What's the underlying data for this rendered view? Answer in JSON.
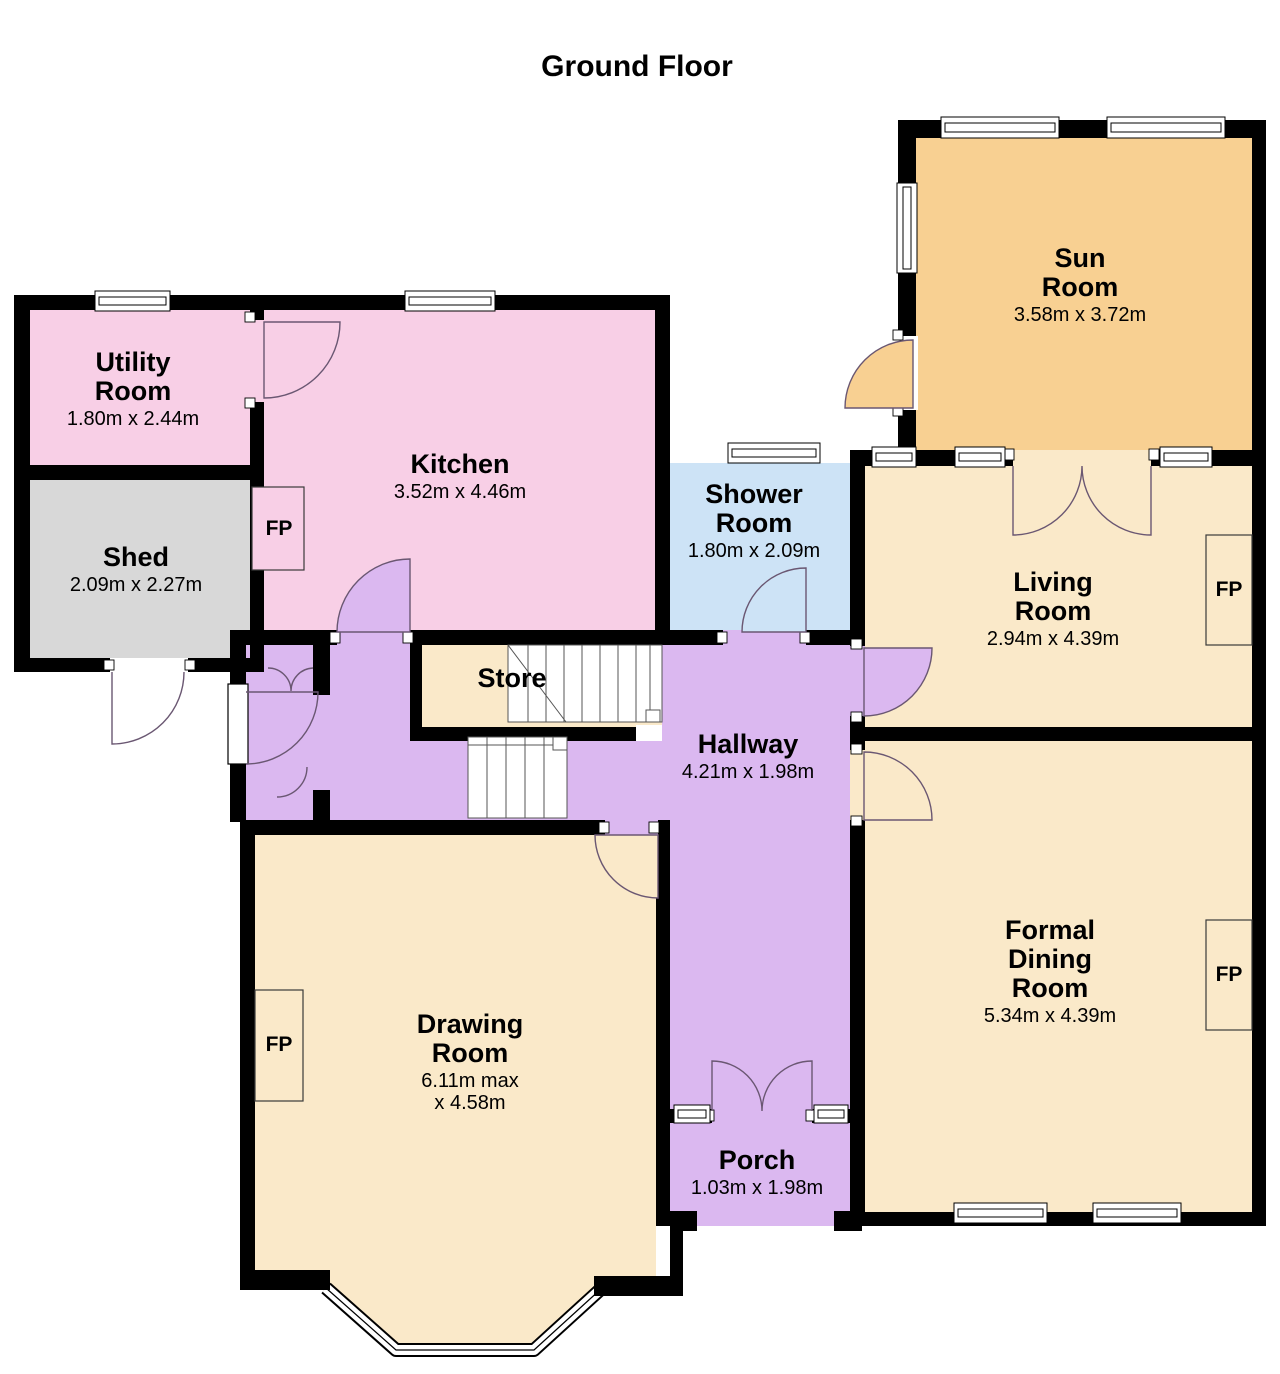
{
  "title": "Ground Floor",
  "rooms": [
    {
      "id": "utility-room",
      "name": "Utility Room",
      "dims": "1.80m x 2.44m",
      "color": "#f8cfe6"
    },
    {
      "id": "shed",
      "name": "Shed",
      "dims": "2.09m x 2.27m",
      "color": "#d8d8d8"
    },
    {
      "id": "kitchen",
      "name": "Kitchen",
      "dims": "3.52m x 4.46m",
      "color": "#f8cfe6"
    },
    {
      "id": "shower-room",
      "name": "Shower Room",
      "dims": "1.80m x 2.09m",
      "color": "#cde3f6"
    },
    {
      "id": "sun-room",
      "name": "Sun Room",
      "dims": "3.58m x 3.72m",
      "color": "#f8d092"
    },
    {
      "id": "living-room",
      "name": "Living Room",
      "dims": "2.94m x 4.39m",
      "color": "#fae9c9"
    },
    {
      "id": "store",
      "name": "Store",
      "dims": "",
      "color": "#fae9c9"
    },
    {
      "id": "hallway",
      "name": "Hallway",
      "dims": "4.21m x 1.98m",
      "color": "#dbb8f0"
    },
    {
      "id": "drawing-room",
      "name": "Drawing Room",
      "dims": "6.11m max x 4.58m",
      "color": "#fae9c9"
    },
    {
      "id": "formal-dining-room",
      "name": "Formal Dining Room",
      "dims": "5.34m x 4.39m",
      "color": "#fae9c9"
    },
    {
      "id": "porch",
      "name": "Porch",
      "dims": "1.03m x 1.98m",
      "color": "#dbb8f0"
    }
  ],
  "fireplace_label": "FP",
  "colors": {
    "wall": "#000000",
    "window": "#ffffff",
    "pink": "#f8cfe6",
    "gray": "#d8d8d8",
    "cream": "#fae9c9",
    "orange": "#f8d092",
    "blue": "#cde3f6",
    "purple": "#dbb8f0"
  }
}
